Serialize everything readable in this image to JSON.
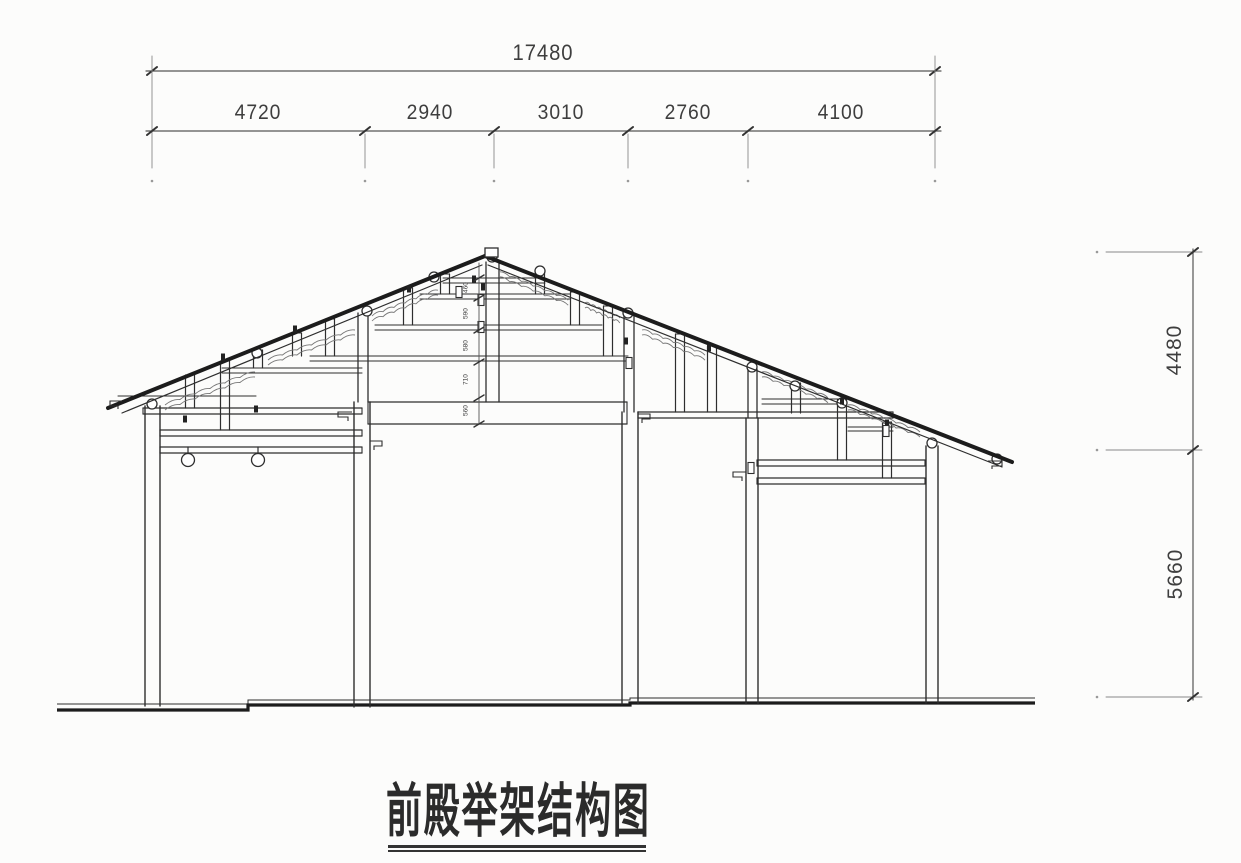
{
  "drawing": {
    "title": "前殿举架结构图"
  },
  "dimensions": {
    "top": {
      "total": "17480",
      "segments": [
        "4720",
        "2940",
        "3010",
        "2760",
        "4100"
      ]
    },
    "right": {
      "upper": "4480",
      "lower": "5660"
    },
    "ridge_chain": [
      "460",
      "590",
      "580",
      "710",
      "560"
    ]
  },
  "colors": {
    "structure_line": "#2e2e2e",
    "heavy_line": "#1c1c1c",
    "dimension_line": "#555555",
    "background": "#fcfcfb"
  }
}
